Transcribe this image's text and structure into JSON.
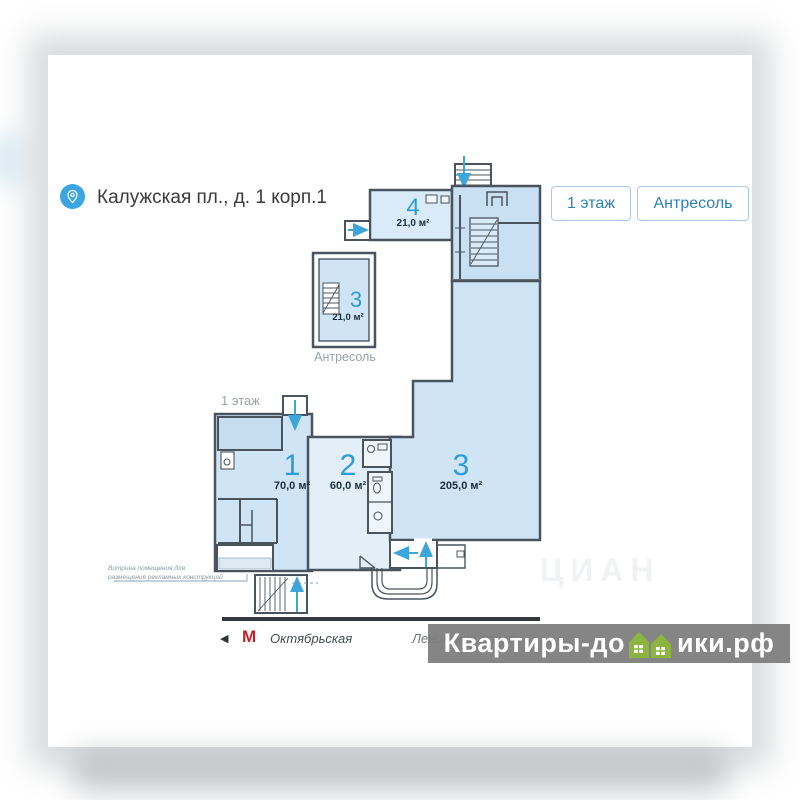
{
  "header": {
    "address": "Калужская пл., д. 1 корп.1"
  },
  "floor_tabs": [
    {
      "label": "1 этаж"
    },
    {
      "label": "Антресоль"
    }
  ],
  "plan": {
    "floor1_label": "1 этаж",
    "mezzanine_label": "Антресоль",
    "rooms": {
      "room1": {
        "number": "1",
        "area": "70,0 м²"
      },
      "room2": {
        "number": "2",
        "area": "60,0 м²"
      },
      "room3": {
        "number": "3",
        "area": "205,0 м²"
      },
      "room4": {
        "number": "4",
        "area": "21,0 м²"
      },
      "mezz_room3": {
        "number": "3",
        "area": "21,0 м²"
      }
    },
    "annotation_line1": "Витрина помещения для",
    "annotation_line2": "размещения рекламных конструкций"
  },
  "transit": {
    "back_arrow": "◀",
    "metro_letter": "М",
    "station": "Октябрьская",
    "street": "Ленинский просп."
  },
  "watermark": {
    "left": "Квартиры-до",
    "right": "ики.рф"
  },
  "faint_watermark": "ЦИАН",
  "colors": {
    "accent_blue": "#2b9cd8",
    "pin_blue": "#3aa5e0",
    "metro_red": "#c5222c",
    "watermark_bg": "#7c7c7c",
    "house_green": "#8cb43e",
    "wall": "#4a545e",
    "room_fill": "#cfe4f5",
    "room_fill_light": "#e2eff9"
  }
}
